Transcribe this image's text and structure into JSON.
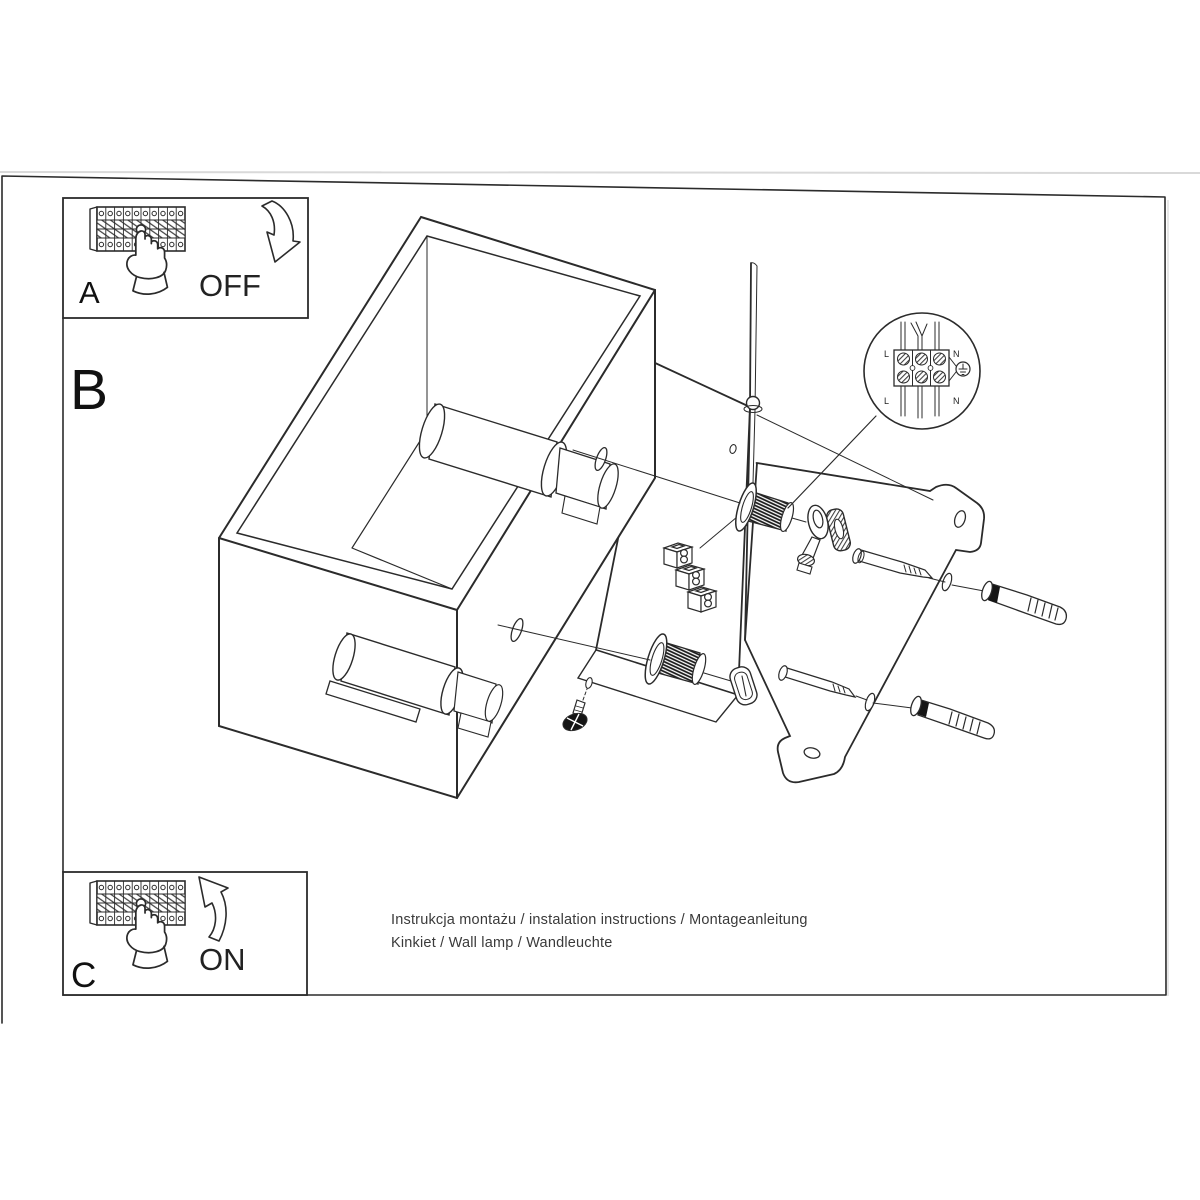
{
  "sections": {
    "a": "A",
    "b": "B",
    "c": "C"
  },
  "switch_labels": {
    "off": "OFF",
    "on": "ON"
  },
  "wiring": {
    "top_left": "L",
    "top_right": "N",
    "bottom_left": "L",
    "bottom_right": "N"
  },
  "footer": {
    "line1": "Instrukcja montażu / instalation instructions / Montageanleitung",
    "line2": "Kinkiet / Wall lamp / Wandleuchte"
  },
  "colors": {
    "ink": "#2b2b2b",
    "text": "#3a3a3a",
    "scan_edge": "#d9d9d9",
    "paper": "#ffffff"
  }
}
